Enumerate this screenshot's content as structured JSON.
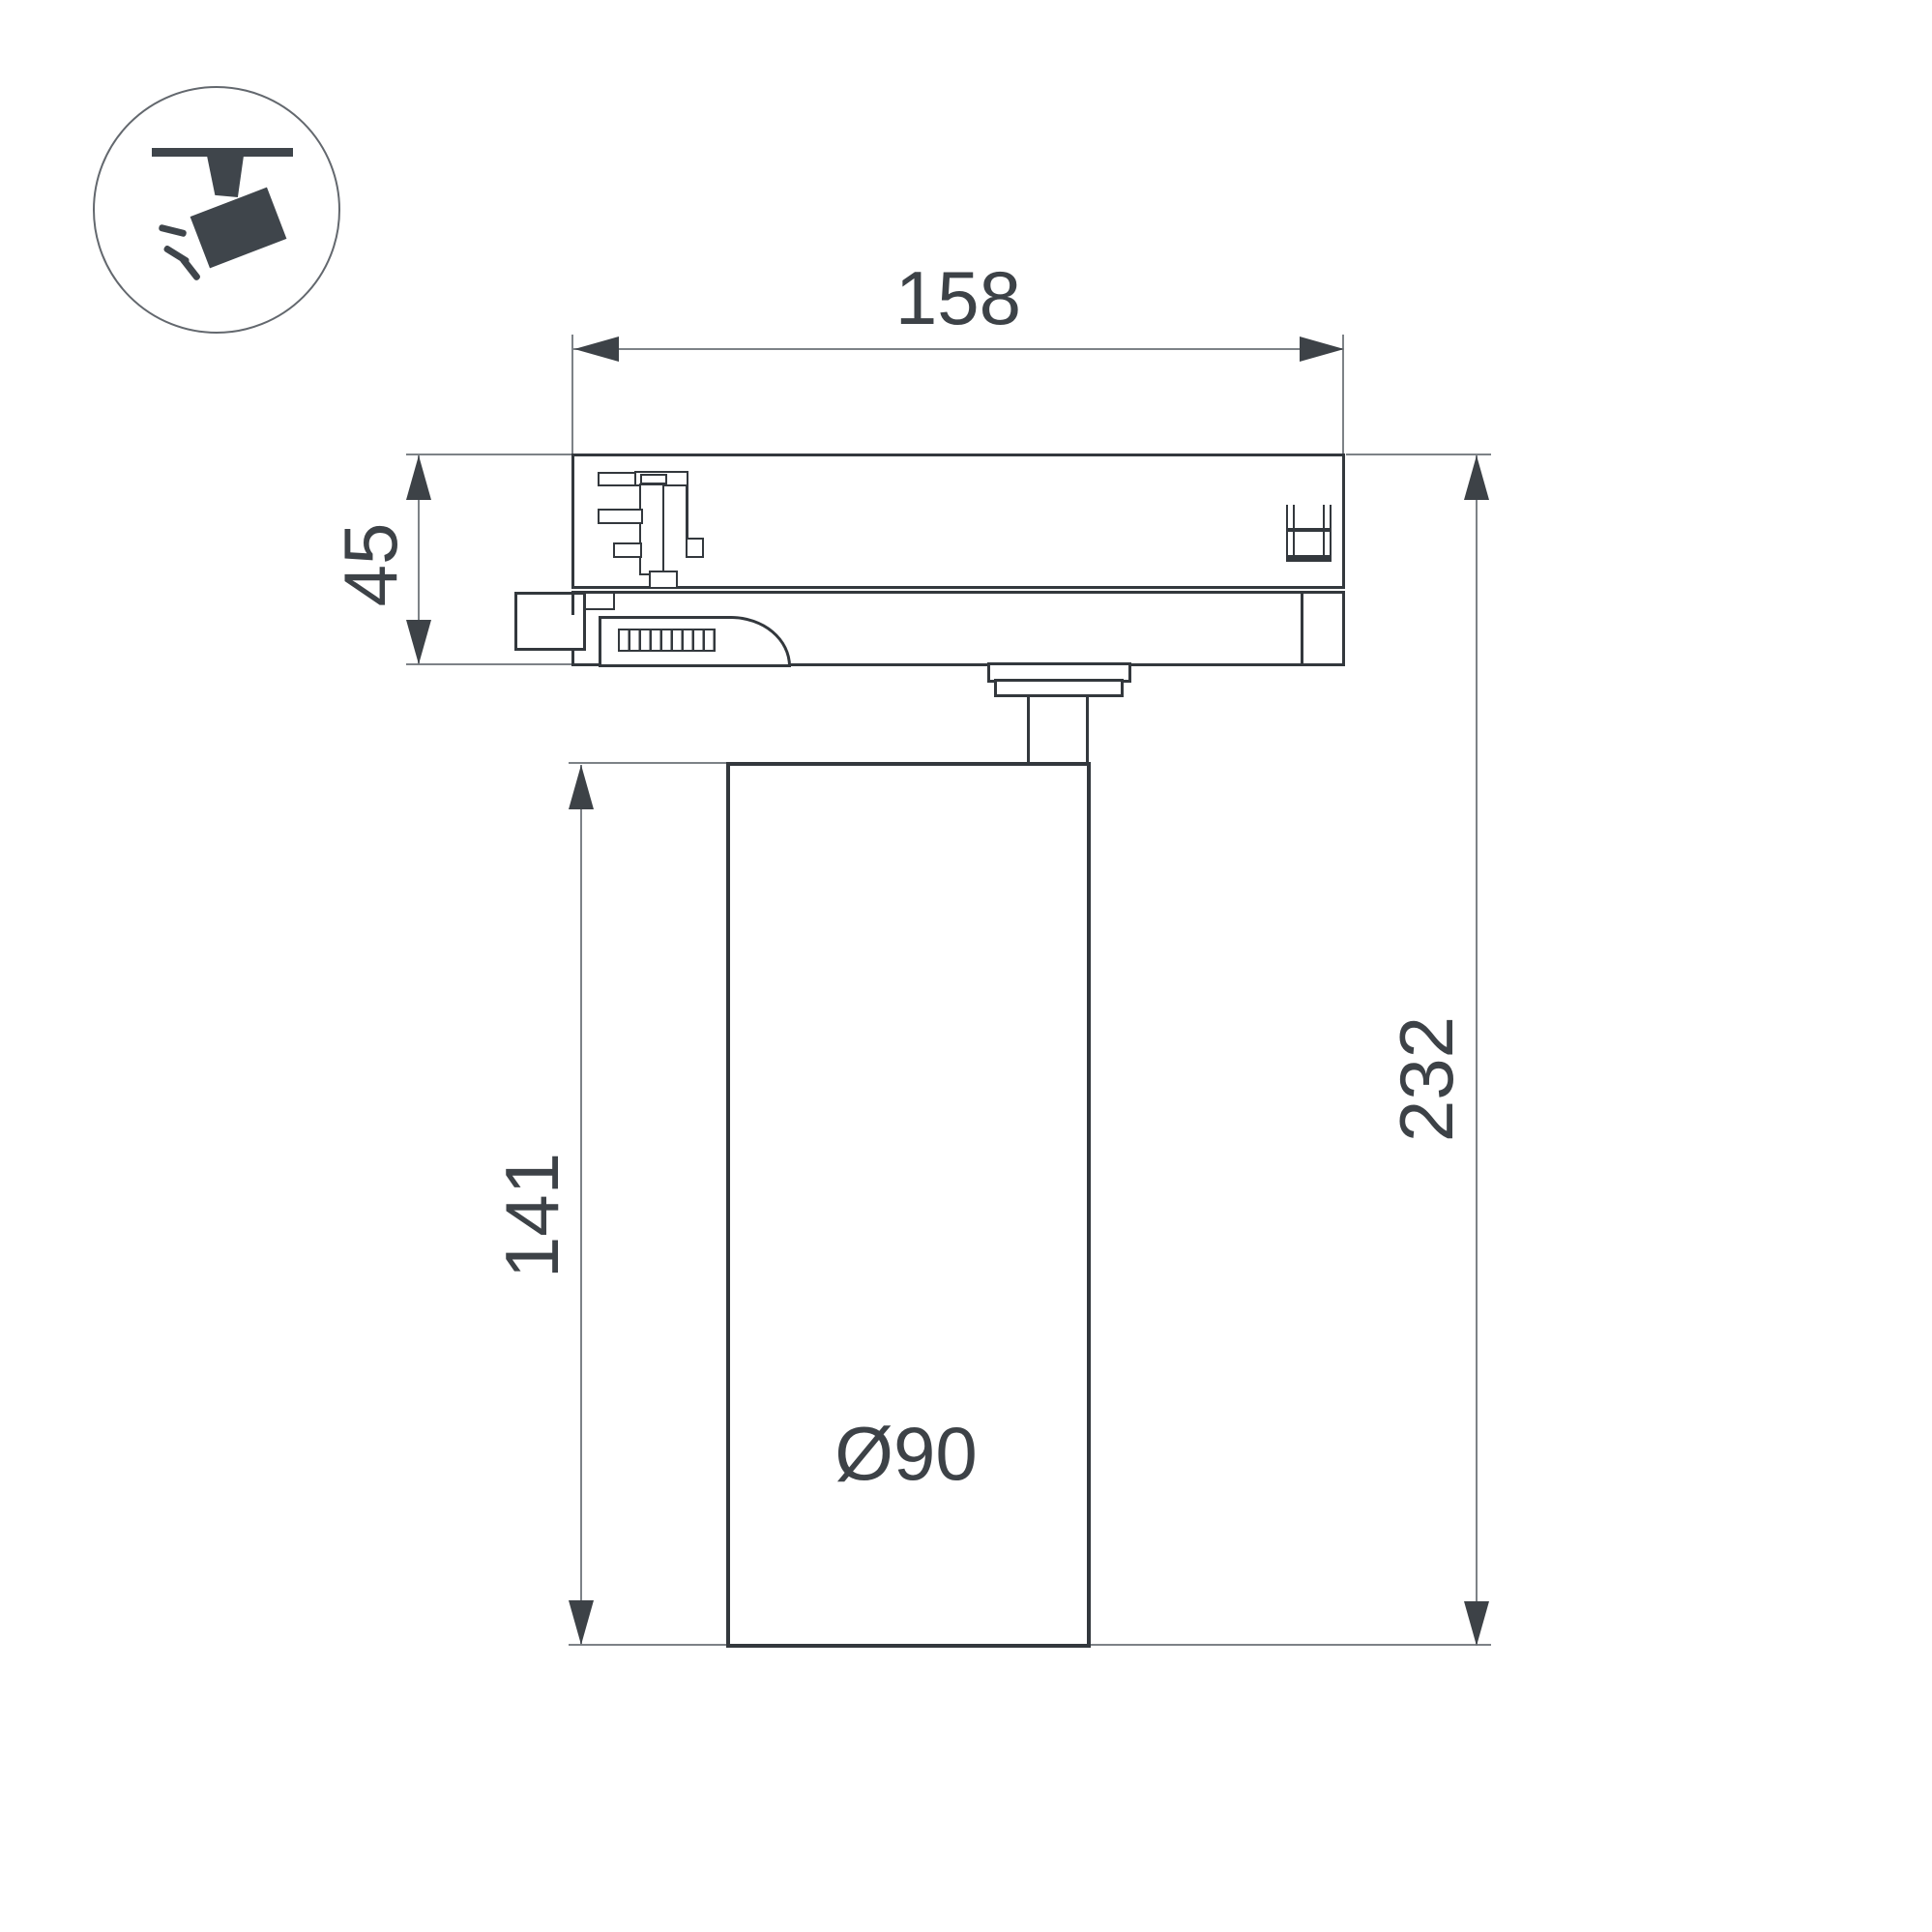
{
  "drawing": {
    "kind": "technical dimension drawing",
    "subject": "3-phase track light fixture, side view"
  },
  "dimensions": {
    "adapter_width": "158",
    "adapter_height": "45",
    "body_height": "141",
    "overall_height": "232",
    "body_diameter": "Ø90"
  },
  "icon": {
    "name": "track-spotlight-icon",
    "parts": [
      "ceiling-track-bar",
      "mount-stem",
      "lamp-head",
      "light-rays"
    ]
  },
  "colors": {
    "outline": "#33383d",
    "dim": "#7d8287",
    "arrow": "#3d4247",
    "label": "#3d4247",
    "icon": "#3f454b"
  }
}
